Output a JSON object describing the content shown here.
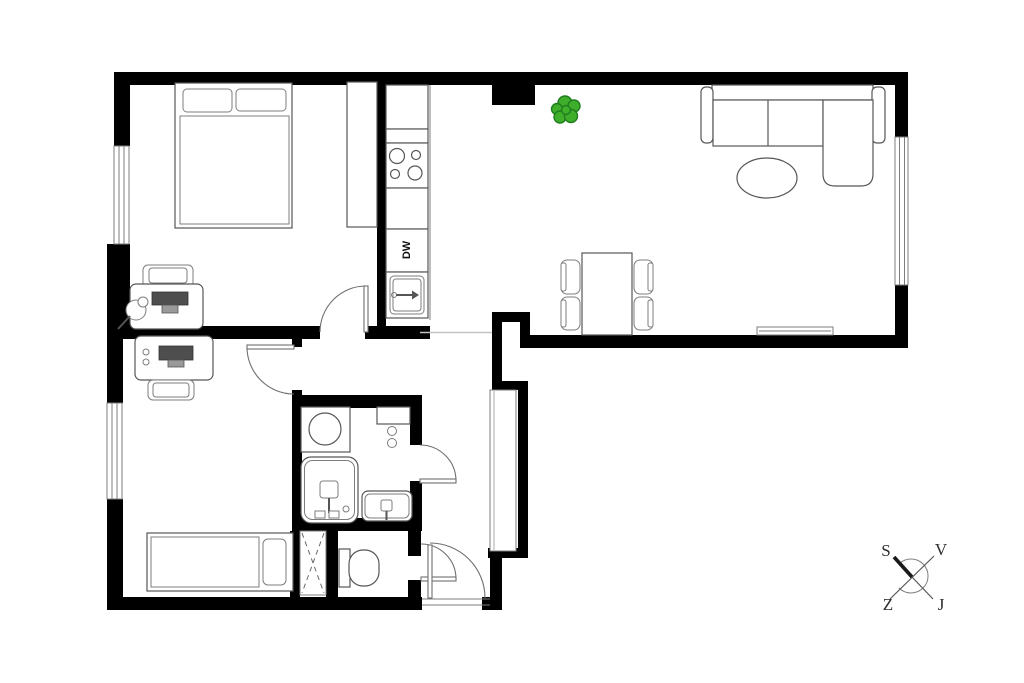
{
  "floorplan": {
    "labels": {
      "dishwasher": "DW"
    },
    "compass": {
      "north": "S",
      "east": "V",
      "west": "Z",
      "south": "J"
    },
    "colors": {
      "wall": "#000000",
      "furniture_outline": "#565656",
      "screen_fill": "#4e4e4e",
      "plant_green": "#3fae2a",
      "plant_dark": "#1f7d1f"
    },
    "icons": [
      "double-bed",
      "wardrobe",
      "desk",
      "office-chair",
      "monitor",
      "desk-lamp",
      "fridge-cabinet",
      "stove",
      "dishwasher",
      "kitchen-sink",
      "single-bed",
      "washing-machine",
      "bath-cabinet",
      "bathtub",
      "bathroom-sink",
      "toilet",
      "installation-shaft",
      "hallway-closet",
      "dining-table",
      "dining-chair",
      "sofa",
      "coffee-table",
      "tv-bench",
      "plant",
      "door-swing",
      "window",
      "compass-rose"
    ]
  }
}
